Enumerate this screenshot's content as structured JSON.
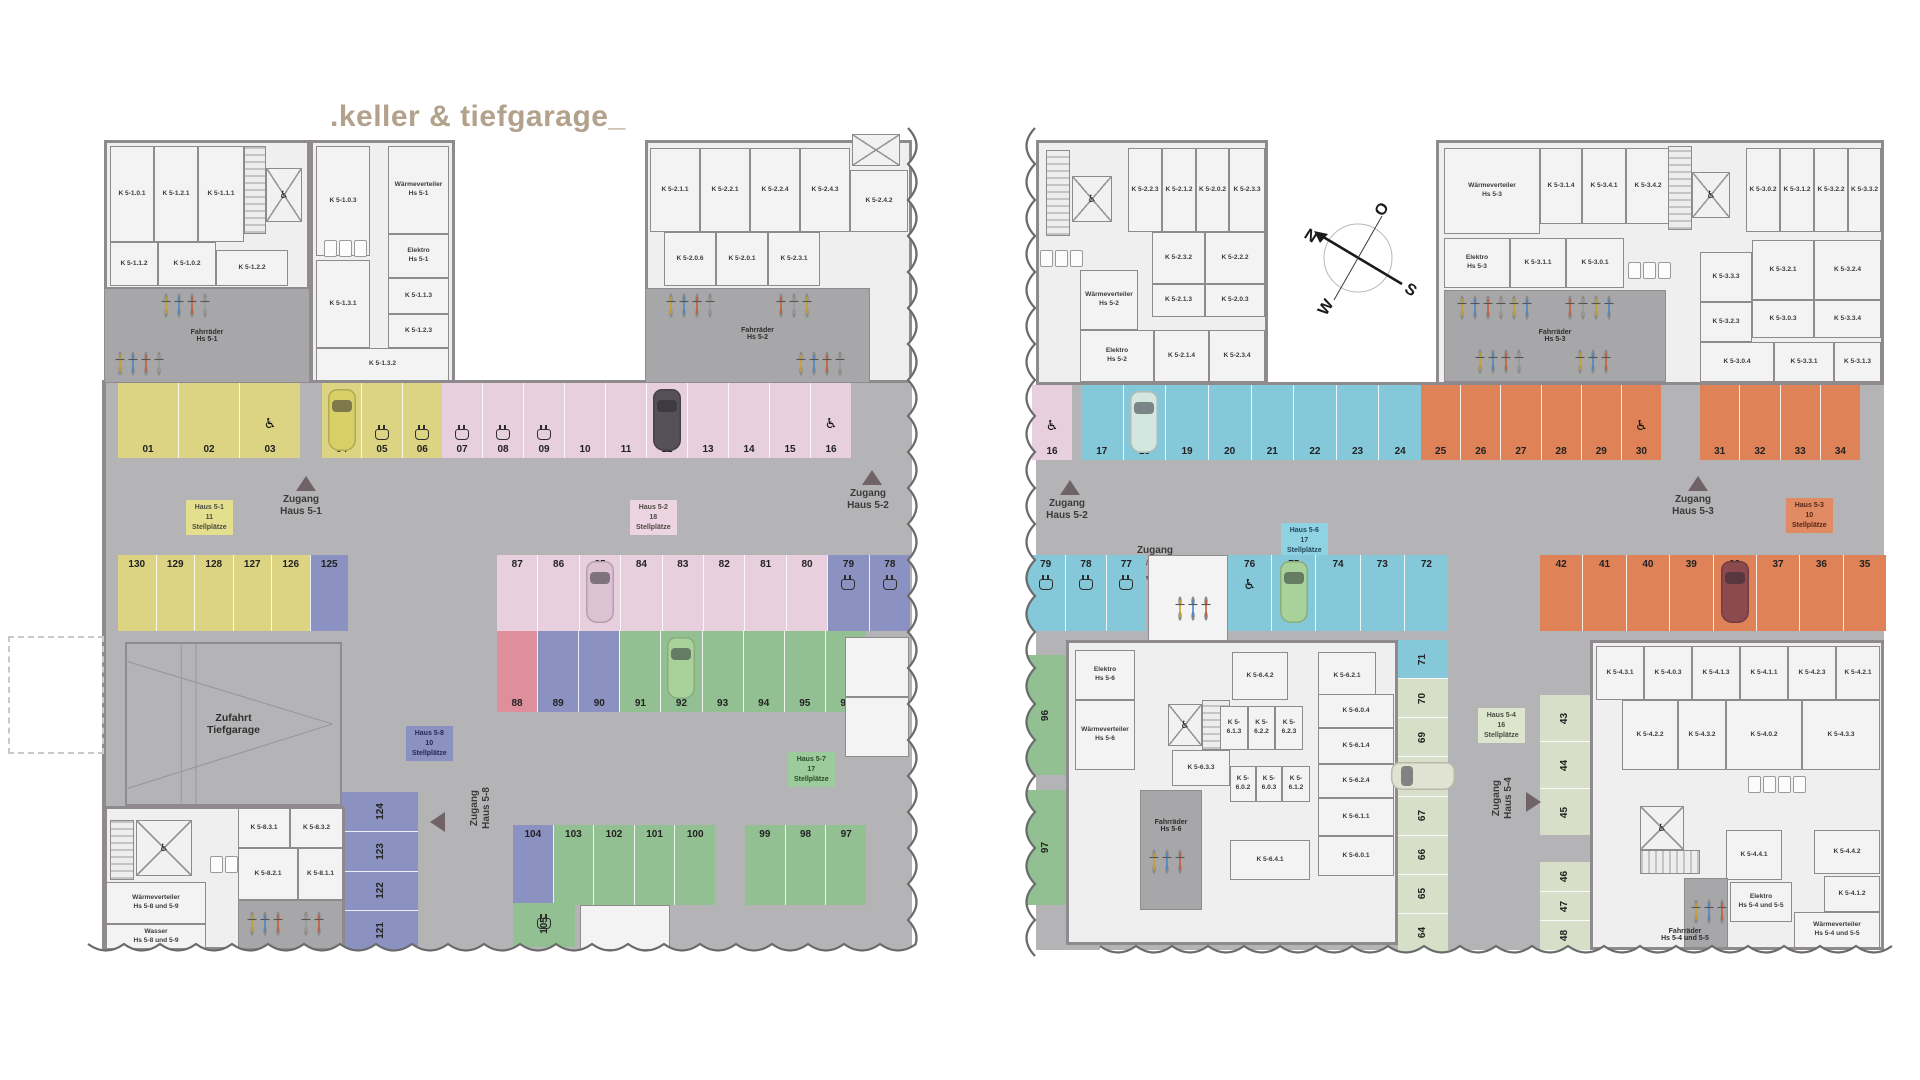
{
  "title": ".keller & tiefgarage_",
  "compass": {
    "n": "N",
    "o": "O",
    "s": "S",
    "w": "W"
  },
  "L": {
    "rooms": {
      "k5101": "K 5-1.0.1",
      "k5121": "K 5-1.2.1",
      "k5111": "K 5-1.1.1",
      "k5112": "K 5-1.1.2",
      "k5102": "K 5-1.0.2",
      "k5122": "K 5-1.2.2",
      "k5103": "K 5-1.0.3",
      "wvh51": "Wärmeverteiler\nHs 5-1",
      "elh51": "Elektro\nHs 5-1",
      "k5113": "K 5-1.1.3",
      "k5123": "K 5-1.2.3",
      "k5131": "K 5-1.3.1",
      "k5132": "K 5-1.3.2",
      "fhh51": "Fahrräder\nHs 5-1",
      "k5211": "K 5-2.1.1",
      "k5221": "K 5-2.2.1",
      "k5224": "K 5-2.2.4",
      "k5243": "K 5-2.4.3",
      "k5242": "K 5-2.4.2",
      "k5206": "K 5-2.0.6",
      "k5201": "K 5-2.0.1",
      "k5231": "K 5-2.3.1",
      "fhh52": "Fahrräder\nHs 5-2",
      "zufahrt": "Zufahrt\nTiefgarage",
      "k5831": "K 5-8.3.1",
      "k5832": "K 5-8.3.2",
      "k5821": "K 5-8.2.1",
      "k5811": "K 5-8.1.1",
      "wvh589": "Wärmeverteiler\nHs 5-8 und 5-9",
      "wash589": "Wasser\nHs 5-8 und 5-9"
    },
    "labels": {
      "zug51": "Zugang\nHaus 5-1",
      "zug52": "Zugang\nHaus 5-2",
      "zug58": "Zugang\nHaus 5-8"
    },
    "badges": {
      "h51": {
        "t": "Haus 5-1",
        "s": "11 Stellplätze"
      },
      "h52": {
        "t": "Haus 5-2",
        "s": "18 Stellplätze"
      },
      "h58": {
        "t": "Haus 5-8",
        "s": "10 Stellplätze"
      },
      "h57": {
        "t": "Haus 5-7",
        "s": "17 Stellplätze"
      }
    },
    "strips": {
      "r1a": {
        "np": "b",
        "cells": [
          {
            "n": "01",
            "c": "y"
          },
          {
            "n": "02",
            "c": "y"
          },
          {
            "n": "03",
            "c": "y",
            "i": [
              "wc"
            ]
          }
        ]
      },
      "r1b": {
        "np": "b",
        "cells": [
          {
            "n": "04",
            "c": "y",
            "i": [
              "carY"
            ]
          },
          {
            "n": "05",
            "c": "y",
            "i": [
              "ev"
            ]
          },
          {
            "n": "06",
            "c": "y",
            "i": [
              "ev"
            ]
          }
        ]
      },
      "r1c": {
        "np": "b",
        "cells": [
          {
            "n": "07",
            "c": "p",
            "i": [
              "ev"
            ]
          },
          {
            "n": "08",
            "c": "p",
            "i": [
              "ev"
            ]
          },
          {
            "n": "09",
            "c": "p",
            "i": [
              "ev"
            ]
          },
          {
            "n": "10",
            "c": "p"
          },
          {
            "n": "11",
            "c": "p"
          },
          {
            "n": "12",
            "c": "p",
            "i": [
              "carD"
            ]
          },
          {
            "n": "13",
            "c": "p"
          },
          {
            "n": "14",
            "c": "p"
          },
          {
            "n": "15",
            "c": "p"
          },
          {
            "n": "16",
            "c": "p",
            "i": [
              "wc"
            ]
          }
        ]
      },
      "r2a": {
        "np": "t",
        "cells": [
          {
            "n": "130",
            "c": "y"
          },
          {
            "n": "129",
            "c": "y"
          },
          {
            "n": "128",
            "c": "y"
          },
          {
            "n": "127",
            "c": "y"
          },
          {
            "n": "126",
            "c": "y"
          },
          {
            "n": "125",
            "c": "b"
          }
        ]
      },
      "r2b": {
        "np": "t",
        "cells": [
          {
            "n": "87",
            "c": "p"
          },
          {
            "n": "86",
            "c": "p"
          },
          {
            "n": "85",
            "c": "p",
            "i": [
              "carP"
            ]
          },
          {
            "n": "84",
            "c": "p"
          },
          {
            "n": "83",
            "c": "p"
          },
          {
            "n": "82",
            "c": "p"
          },
          {
            "n": "81",
            "c": "p"
          },
          {
            "n": "80",
            "c": "p"
          },
          {
            "n": "79",
            "c": "b",
            "i": [
              "ev"
            ]
          },
          {
            "n": "78",
            "c": "b",
            "i": [
              "ev"
            ]
          }
        ]
      },
      "r3": {
        "np": "b",
        "cells": [
          {
            "n": "88",
            "c": "r"
          },
          {
            "n": "89",
            "c": "b"
          },
          {
            "n": "90",
            "c": "b"
          },
          {
            "n": "91",
            "c": "g"
          },
          {
            "n": "92",
            "c": "g",
            "i": [
              "carG"
            ]
          },
          {
            "n": "93",
            "c": "g"
          },
          {
            "n": "94",
            "c": "g"
          },
          {
            "n": "95",
            "c": "g"
          },
          {
            "n": "96",
            "c": "g"
          }
        ]
      },
      "rb1": {
        "np": "t",
        "cells": [
          {
            "n": "104",
            "c": "b"
          },
          {
            "n": "103",
            "c": "g"
          },
          {
            "n": "102",
            "c": "g"
          },
          {
            "n": "101",
            "c": "g"
          },
          {
            "n": "100",
            "c": "g"
          }
        ]
      },
      "rb2": {
        "np": "t",
        "cells": [
          {
            "n": "99",
            "c": "g"
          },
          {
            "n": "98",
            "c": "g"
          },
          {
            "n": "97",
            "c": "g"
          }
        ]
      },
      "v124": {
        "np": "v",
        "cells": [
          {
            "n": "124",
            "c": "b"
          },
          {
            "n": "123",
            "c": "b"
          },
          {
            "n": "122",
            "c": "b"
          },
          {
            "n": "121",
            "c": "b"
          }
        ]
      },
      "v105": {
        "np": "v",
        "cells": [
          {
            "n": "105",
            "c": "g",
            "i": [
              "ev"
            ]
          }
        ]
      }
    }
  },
  "R": {
    "rooms": {
      "k5223": "K 5-2.2.3",
      "k5212": "K 5-2.1.2",
      "k5202": "K 5-2.0.2",
      "k5233": "K 5-2.3.3",
      "k5232": "K 5-2.3.2",
      "k5222": "K 5-2.2.2",
      "k5213": "K 5-2.1.3",
      "k5203": "K 5-2.0.3",
      "wvh52": "Wärmeverteiler\nHs 5-2",
      "elh52": "Elektro\nHs 5-2",
      "k5214": "K 5-2.1.4",
      "k5234": "K 5-2.3.4",
      "wvh53": "Wärmeverteiler\nHs 5-3",
      "k5314": "K 5-3.1.4",
      "k5341": "K 5-3.4.1",
      "k5342": "K 5-3.4.2",
      "elh53": "Elektro\nHs 5-3",
      "k5311": "K 5-3.1.1",
      "k5301": "K 5-3.0.1",
      "fhh53": "Fahrräder\nHs 5-3",
      "k5302": "K 5-3.0.2",
      "k5312": "K 5-3.1.2",
      "k5322": "K 5-3.2.2",
      "k5332": "K 5-3.3.2",
      "k5333": "K 5-3.3.3",
      "k5321": "K 5-3.2.1",
      "k5324": "K 5-3.2.4",
      "k5303": "K 5-3.0.3",
      "k5334": "K 5-3.3.4",
      "k5323": "K 5-3.2.3",
      "k5304": "K 5-3.0.4",
      "k5331": "K 5-3.3.1",
      "k5313": "K 5-3.1.3",
      "elh56": "Elektro\nHs 5-6",
      "wvh56": "Wärmeverteiler\nHs 5-6",
      "k5642": "K 5-6.4.2",
      "k5621": "K 5-6.2.1",
      "k5632": "K 5-6.3.2",
      "k5613": "K 5-6.1.3",
      "k5622": "K 5-6.2.2",
      "k5623": "K 5-6.2.3",
      "k5633": "K 5-6.3.3",
      "k5602": "K 5-6.0.2",
      "k5603": "K 5-6.0.3",
      "k5612": "K 5-6.1.2",
      "k5604": "K 5-6.0.4",
      "k5614": "K 5-6.1.4",
      "k5624": "K 5-6.2.4",
      "k5611": "K 5-6.1.1",
      "k5601": "K 5-6.0.1",
      "k5641": "K 5-6.4.1",
      "fhh56": "Fahrräder\nHs 5-6",
      "k5431": "K 5-4.3.1",
      "k5403": "K 5-4.0.3",
      "k5413": "K 5-4.1.3",
      "k5411": "K 5-4.1.1",
      "k5423": "K 5-4.2.3",
      "k5421": "K 5-4.2.1",
      "k5422": "K 5-4.2.2",
      "k5432": "K 5-4.3.2",
      "k5402": "K 5-4.0.2",
      "k5433": "K 5-4.3.3",
      "k5441": "K 5-4.4.1",
      "k5442": "K 5-4.4.2",
      "k5412": "K 5-4.1.2",
      "elh545": "Elektro\nHs 5-4 und 5-5",
      "fhh545": "Fahrräder\nHs 5-4 und 5-5",
      "wvh545": "Wärmeverteiler\nHs 5-4 und 5-5"
    },
    "labels": {
      "zug52": "Zugang\nHaus 5-2",
      "zug56": "Zugang\nHaus 5-6",
      "zug53": "Zugang\nHaus 5-3",
      "zug54": "Zugang\nHaus 5-4"
    },
    "badges": {
      "h56": {
        "t": "Haus 5-6",
        "s": "17 Stellplätze"
      },
      "h53": {
        "t": "Haus 5-3",
        "s": "10 Stellplätze"
      },
      "h54": {
        "t": "Haus 5-4",
        "s": "16 Stellplätze"
      }
    },
    "strips": {
      "r1a": {
        "np": "b",
        "cells": [
          {
            "n": "16",
            "c": "p",
            "i": [
              "wc"
            ]
          }
        ]
      },
      "r1b": {
        "np": "b",
        "cells": [
          {
            "n": "17",
            "c": "c"
          },
          {
            "n": "18",
            "c": "c",
            "i": [
              "carC"
            ]
          },
          {
            "n": "19",
            "c": "c"
          },
          {
            "n": "20",
            "c": "c"
          },
          {
            "n": "21",
            "c": "c"
          },
          {
            "n": "22",
            "c": "c"
          },
          {
            "n": "23",
            "c": "c"
          },
          {
            "n": "24",
            "c": "c"
          }
        ]
      },
      "r1c": {
        "np": "b",
        "cells": [
          {
            "n": "25",
            "c": "o"
          },
          {
            "n": "26",
            "c": "o"
          },
          {
            "n": "27",
            "c": "o"
          },
          {
            "n": "28",
            "c": "o"
          },
          {
            "n": "29",
            "c": "o"
          },
          {
            "n": "30",
            "c": "o",
            "i": [
              "wc"
            ]
          }
        ]
      },
      "r1d": {
        "np": "b",
        "cells": [
          {
            "n": "31",
            "c": "o"
          },
          {
            "n": "32",
            "c": "o"
          },
          {
            "n": "33",
            "c": "o"
          },
          {
            "n": "34",
            "c": "o"
          }
        ]
      },
      "r2a": {
        "np": "t",
        "cells": [
          {
            "n": "79",
            "c": "c",
            "i": [
              "ev"
            ]
          },
          {
            "n": "78",
            "c": "c",
            "i": [
              "ev"
            ]
          },
          {
            "n": "77",
            "c": "c",
            "i": [
              "ev"
            ]
          }
        ]
      },
      "r2b": {
        "np": "t",
        "cells": [
          {
            "n": "76",
            "c": "c",
            "i": [
              "wc"
            ]
          },
          {
            "n": "75",
            "c": "c",
            "i": [
              "carG"
            ]
          },
          {
            "n": "74",
            "c": "c"
          },
          {
            "n": "73",
            "c": "c"
          },
          {
            "n": "72",
            "c": "c"
          }
        ]
      },
      "r2c": {
        "np": "t",
        "cells": [
          {
            "n": "42",
            "c": "o"
          },
          {
            "n": "41",
            "c": "o"
          },
          {
            "n": "40",
            "c": "o"
          },
          {
            "n": "39",
            "c": "o"
          },
          {
            "n": "38",
            "c": "o",
            "i": [
              "carR"
            ]
          },
          {
            "n": "37",
            "c": "o"
          },
          {
            "n": "36",
            "c": "o"
          },
          {
            "n": "35",
            "c": "o"
          }
        ]
      },
      "v96": {
        "np": "v",
        "cells": [
          {
            "n": "96",
            "c": "g"
          }
        ]
      },
      "v97": {
        "np": "v",
        "cells": [
          {
            "n": "97",
            "c": "g"
          }
        ]
      },
      "v71": {
        "np": "v",
        "cells": [
          {
            "n": "71",
            "c": "c"
          },
          {
            "n": "70",
            "c": "lg"
          },
          {
            "n": "69",
            "c": "lg"
          },
          {
            "n": "68",
            "c": "lg",
            "i": [
              "carLh"
            ]
          },
          {
            "n": "67",
            "c": "lg"
          },
          {
            "n": "66",
            "c": "lg"
          },
          {
            "n": "65",
            "c": "lg"
          },
          {
            "n": "64",
            "c": "lg"
          }
        ]
      },
      "v43": {
        "np": "v",
        "cells": [
          {
            "n": "43",
            "c": "lg"
          },
          {
            "n": "44",
            "c": "lg"
          },
          {
            "n": "45",
            "c": "lg"
          }
        ]
      },
      "v46": {
        "np": "v",
        "cells": [
          {
            "n": "46",
            "c": "lg"
          },
          {
            "n": "47",
            "c": "lg"
          },
          {
            "n": "48",
            "c": "lg"
          }
        ]
      }
    }
  }
}
